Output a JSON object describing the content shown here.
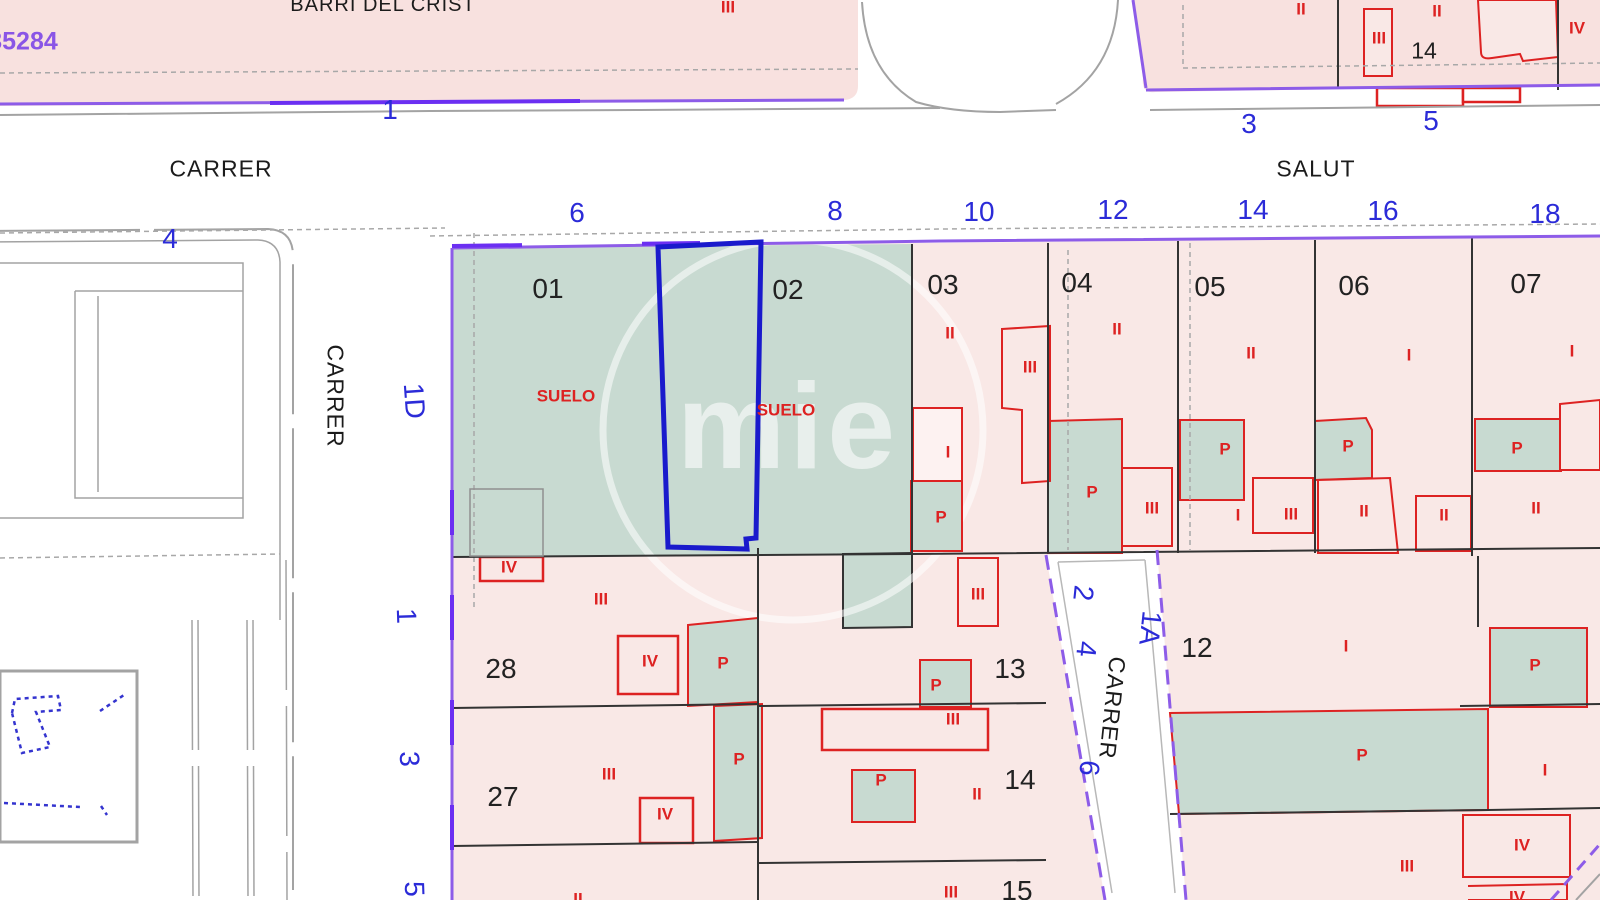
{
  "sheet_ref": "35284",
  "watermark": "mie",
  "streets": [
    {
      "name": "BARRI DEL CRIST"
    },
    {
      "name": "CARRER"
    },
    {
      "name": "SALUT"
    },
    {
      "name": "CARRER"
    },
    {
      "name": "CARRER"
    }
  ],
  "house_numbers": [
    "1",
    "4",
    "3",
    "5",
    "6",
    "8",
    "10",
    "12",
    "14",
    "16",
    "18",
    "1D",
    "1",
    "3",
    "5",
    "2",
    "4",
    "6",
    "1A"
  ],
  "parcel_numbers": [
    "01",
    "02",
    "03",
    "04",
    "05",
    "06",
    "07",
    "14",
    "28",
    "27",
    "13",
    "14",
    "15",
    "12"
  ],
  "building_labels": [
    "III",
    "II",
    "III",
    "II",
    "IV",
    "SUELO",
    "SUELO",
    "II",
    "III",
    "I",
    "P",
    "II",
    "P",
    "III",
    "II",
    "P",
    "I",
    "III",
    "I",
    "P",
    "II",
    "II",
    "I",
    "P",
    "II",
    "IV",
    "III",
    "IV",
    "P",
    "III",
    "P",
    "III",
    "IV",
    "P",
    "III",
    "P",
    "II",
    "III",
    "II",
    "I",
    "P",
    "P",
    "I",
    "IV",
    "III",
    "IV"
  ],
  "colors": {
    "block_fill": "#f8e1df",
    "parcel_fill": "#f9e8e6",
    "suelo_green": "#c8dad1",
    "selected_parcel": "#1a1acc",
    "boundary_purple": "#8d5ce8",
    "building_red": "#dd2222",
    "street_number_blue": "#2b2bd8"
  }
}
